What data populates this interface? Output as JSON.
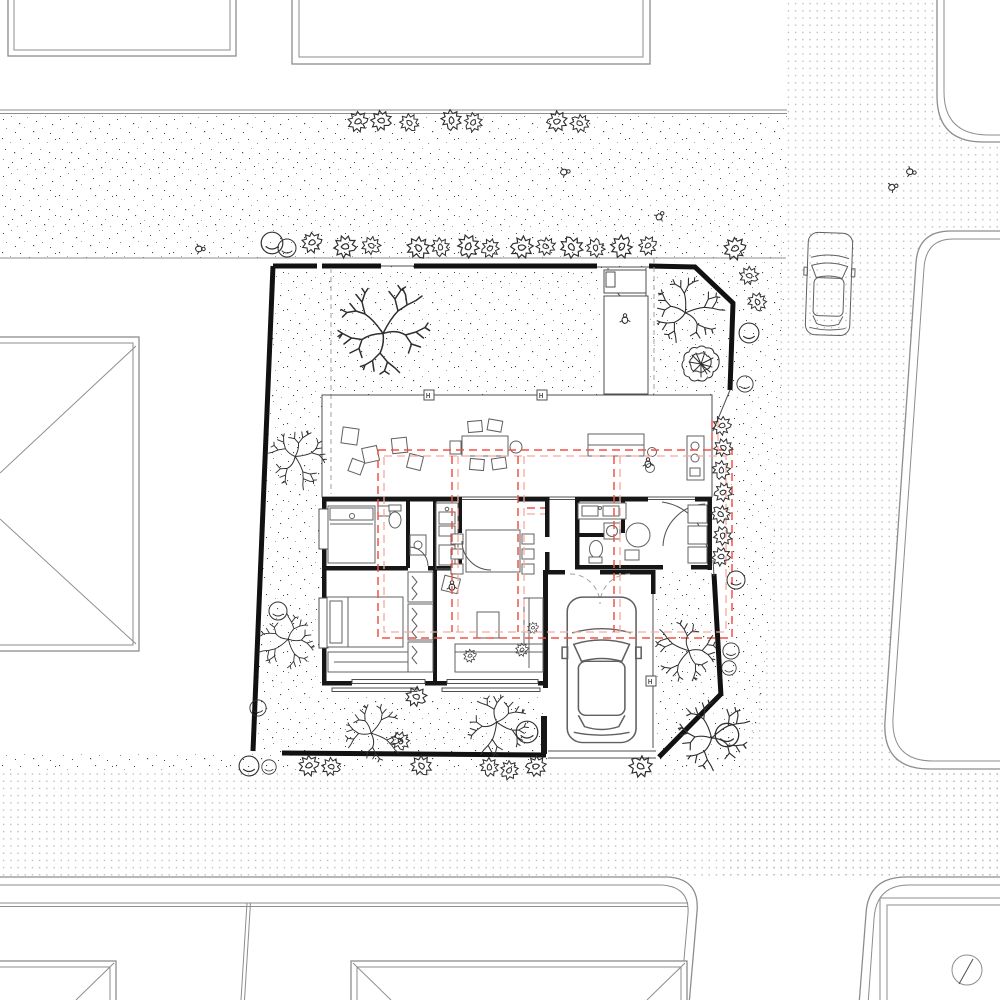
{
  "page": {
    "title": "Residential site plan — ground floor plan with garden, carport and street context",
    "drawing_type": "architectural site / floor plan, top view, black line work on white with red dashed roof outline"
  },
  "colors": {
    "paper": "#ffffff",
    "wall": "#161616",
    "fence": "#111111",
    "thin": "#4f4f4f",
    "context": "#8d8d8d",
    "furniture": "#606060",
    "tree": "#2f2f2f",
    "stipple": "#454545",
    "dots": "#b3b3b3",
    "roof_red": "#ee5347",
    "roof_red_light": "#f7a99f",
    "guide": "#a0a0a0"
  },
  "plan": {
    "column_glyph": "H",
    "textures": {
      "gravel": "irregular stipple speckle (site garden, alley, verge)",
      "asphalt": "regular fine dot grid (streets)"
    },
    "counts": {
      "neighbor_parcels": 8,
      "deciduous_trees": 8,
      "dense_shrub_trees": 1,
      "star_shrubs": 39,
      "round_shrubs": 13,
      "people_figures": 8,
      "cars": 2,
      "column_markers": 3
    },
    "features": [
      "fenced corner plot with diagonal cut corners",
      "linear pavilion with covered terrace, dining table, kitchen island",
      "two bedrooms, two bathrooms, kitchen galley, living room with L-sofa",
      "entry court from north lane, carport with car to street at south",
      "red dashed canopy/roof outline over the private wing",
      "north-arrow circle symbol on the lower-right parcel"
    ]
  }
}
